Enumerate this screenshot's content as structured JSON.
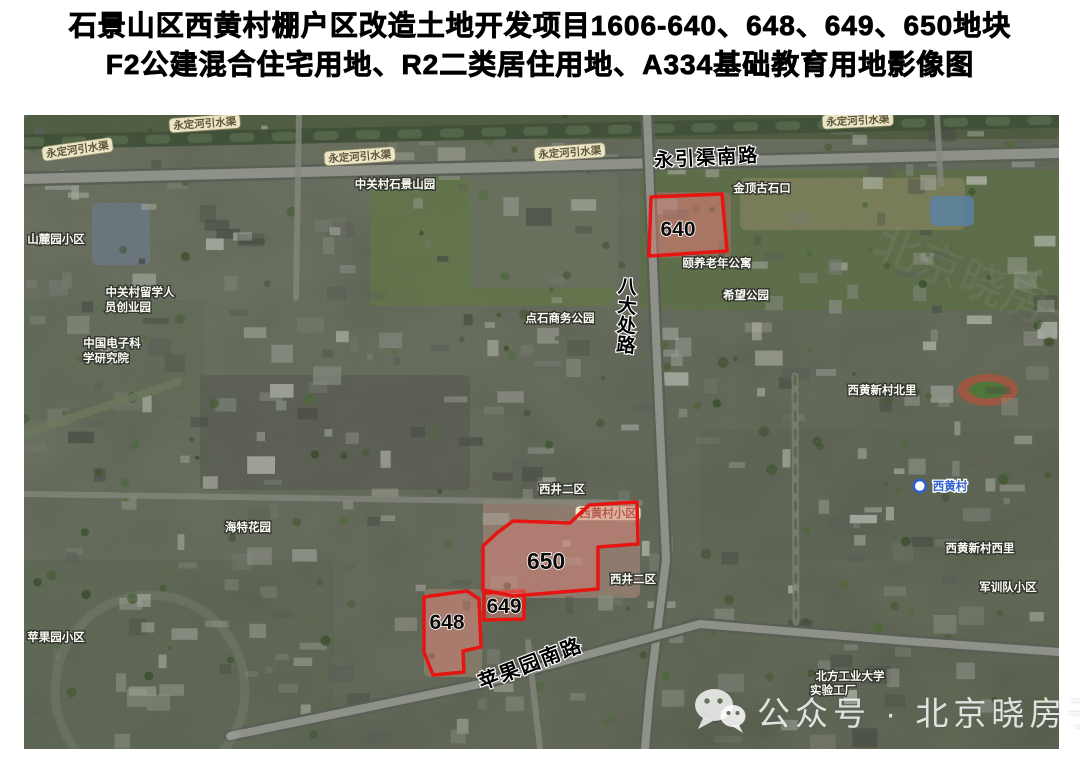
{
  "title": {
    "line1": "石景山区西黄村棚户区改造土地开发项目1606-640、648、649、650地块",
    "line2": "F2公建混合住宅用地、R2二类居住用地、A334基础教育用地影像图"
  },
  "map": {
    "colors": {
      "parcel_stroke": "#e61512",
      "parcel_fill": "rgba(206,126,116,0.5)",
      "road_label_color": "#000000",
      "pill_bg": "#f6efcf",
      "pill_text": "#5d563a",
      "place_text": "#fdfdf6",
      "station_text": "#2f5fd0",
      "red_text": "#a03a2c"
    },
    "parcels": [
      {
        "id": "640",
        "label_x": 678,
        "label_y": 236,
        "size": 21,
        "points": [
          [
            651,
            197
          ],
          [
            722,
            194
          ],
          [
            727,
            251
          ],
          [
            649,
            256
          ]
        ]
      },
      {
        "id": "648",
        "label_x": 447,
        "label_y": 629,
        "size": 21,
        "points": [
          [
            424,
            597
          ],
          [
            467,
            591
          ],
          [
            479,
            599
          ],
          [
            481,
            647
          ],
          [
            463,
            651
          ],
          [
            464,
            672
          ],
          [
            433,
            675
          ],
          [
            424,
            652
          ]
        ]
      },
      {
        "id": "649",
        "label_x": 504,
        "label_y": 613,
        "size": 21,
        "points": [
          [
            484,
            593
          ],
          [
            524,
            591
          ],
          [
            524,
            619
          ],
          [
            484,
            620
          ]
        ]
      },
      {
        "id": "650",
        "label_x": 546,
        "label_y": 569,
        "size": 23,
        "points": [
          [
            483,
            546
          ],
          [
            497,
            533
          ],
          [
            513,
            521
          ],
          [
            570,
            523
          ],
          [
            589,
            505
          ],
          [
            637,
            502
          ],
          [
            638,
            544
          ],
          [
            598,
            547
          ],
          [
            598,
            589
          ],
          [
            513,
            596
          ],
          [
            483,
            590
          ]
        ]
      }
    ],
    "road_labels": [
      {
        "text": "永引渠南路",
        "x": 707,
        "y": 164,
        "rotate": -3,
        "size": 19,
        "vertical": false
      },
      {
        "text": "八大处路",
        "x": 627,
        "y": 293,
        "rotate": 0,
        "size": 19,
        "vertical": true
      },
      {
        "text": "苹果园南路",
        "x": 533,
        "y": 670,
        "rotate": -21,
        "size": 20,
        "vertical": false
      }
    ],
    "small_labels": [
      {
        "text": "永定河引水渠",
        "x": 78,
        "y": 153,
        "style": "pill",
        "rotate": -8
      },
      {
        "text": "永定河引水渠",
        "x": 205,
        "y": 127,
        "style": "pill",
        "rotate": -4
      },
      {
        "text": "永定河引水渠",
        "x": 360,
        "y": 160,
        "style": "pill",
        "rotate": -4
      },
      {
        "text": "永定河引水渠",
        "x": 570,
        "y": 156,
        "style": "pill",
        "rotate": -4
      },
      {
        "text": "永定河引水渠",
        "x": 858,
        "y": 124,
        "style": "pill",
        "rotate": -3
      },
      {
        "text": "中关村石景山园",
        "x": 395,
        "y": 188,
        "style": "place",
        "rotate": 0
      },
      {
        "text": "山麓园小区",
        "x": 56,
        "y": 243,
        "style": "place",
        "rotate": 0
      },
      {
        "text": "中关村留学人",
        "x": 140,
        "y": 296,
        "style": "place",
        "rotate": 0
      },
      {
        "text": "员创业园",
        "x": 128,
        "y": 311,
        "style": "place",
        "rotate": 0
      },
      {
        "text": "中国电子科",
        "x": 112,
        "y": 347,
        "style": "place",
        "rotate": 0
      },
      {
        "text": "学研究院",
        "x": 106,
        "y": 362,
        "style": "place",
        "rotate": 0
      },
      {
        "text": "金顶古石口",
        "x": 762,
        "y": 192,
        "style": "place",
        "rotate": 0
      },
      {
        "text": "颐养老年公寓",
        "x": 717,
        "y": 267,
        "style": "place",
        "rotate": 0
      },
      {
        "text": "希望公园",
        "x": 746,
        "y": 299,
        "style": "place",
        "rotate": 0
      },
      {
        "text": "点石商务公园",
        "x": 560,
        "y": 322,
        "style": "place",
        "rotate": 0
      },
      {
        "text": "西黄新村北里",
        "x": 882,
        "y": 394,
        "style": "place",
        "rotate": 0
      },
      {
        "text": "西井二区",
        "x": 562,
        "y": 493,
        "style": "place",
        "rotate": 0
      },
      {
        "text": "西黄村小区",
        "x": 608,
        "y": 517,
        "style": "red",
        "rotate": 0
      },
      {
        "text": "西黄村",
        "x": 950,
        "y": 490,
        "style": "station",
        "rotate": 0
      },
      {
        "text": "海特花园",
        "x": 248,
        "y": 531,
        "style": "place",
        "rotate": 0
      },
      {
        "text": "西黄新村西里",
        "x": 980,
        "y": 552,
        "style": "place",
        "rotate": 0
      },
      {
        "text": "西井二区",
        "x": 633,
        "y": 583,
        "style": "place",
        "rotate": 0
      },
      {
        "text": "军训队小区",
        "x": 1008,
        "y": 591,
        "style": "place",
        "rotate": 0
      },
      {
        "text": "苹果园小区",
        "x": 56,
        "y": 641,
        "style": "place",
        "rotate": 0
      },
      {
        "text": "北方工业大学",
        "x": 850,
        "y": 680,
        "style": "place",
        "rotate": 0
      },
      {
        "text": "实验工厂",
        "x": 833,
        "y": 694,
        "style": "place",
        "rotate": 0
      }
    ]
  },
  "watermark": {
    "icon": "wechat-icon",
    "text": "公众号 · 北京晓房子"
  }
}
